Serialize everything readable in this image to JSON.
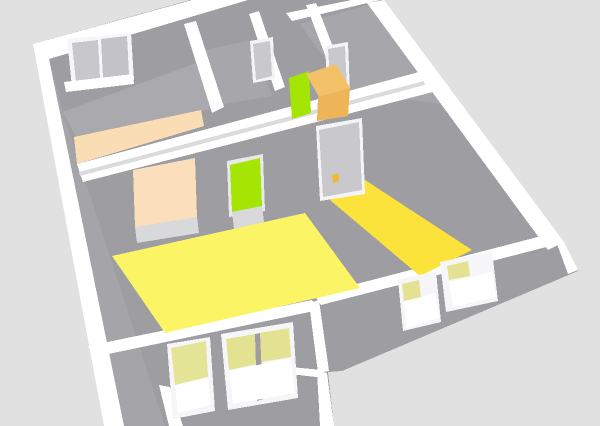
{
  "view": {
    "label": "3d-floor-plan-view",
    "tool": "home-3d-preview",
    "width": 600,
    "height": 426,
    "background": "#E1E1E1"
  },
  "colors": {
    "background": "#E1E1E1",
    "wall_gray": "#9D9DA2",
    "floor_gray": "#A9A9AE",
    "wall_top_white": "#FFFFFF",
    "accent_peach": "#FBDDB5",
    "accent_green": "#A5E503",
    "floor_yellow_light": "#FBF565",
    "floor_yellow_gold": "#FCE33C",
    "furniture_orange": "#F3C168",
    "door_gray": "#C8C8CD",
    "handle_yellow": "#F2B830",
    "window_pane_gray": "#C7C7CC",
    "window_glass_yellow": "#E2E292"
  },
  "scene": {
    "polygons": [
      {
        "name": "house-base-walls",
        "fill": "#9D9DA2",
        "points": "33,44 190,0 383,0 562,241 578,271 342,371 328,372 334,426 108,426 95,352"
      },
      {
        "name": "backleft-room-floor",
        "fill": "#A9A9AE",
        "points": "63,112 250,43 216,108 76,137"
      },
      {
        "name": "small-room-floor",
        "fill": "#A6A6AB",
        "points": "205,50 252,40 272,96 224,104"
      },
      {
        "name": "topright-room-floor",
        "fill": "#A6A6AB",
        "points": "300,24 376,3 458,106 348,92"
      },
      {
        "name": "left-wall-inner-face",
        "fill": "#A4A4A9",
        "points": "49,59 63,112 165,426 124,426"
      },
      {
        "name": "back-wall-top-band",
        "fill": "#FFFFFF",
        "points": "33,44 192,0 248,0 49,59"
      },
      {
        "name": "left-wall-top-band",
        "fill": "#FFFFFF",
        "points": "33,44 49,59 124,426 104,426"
      },
      {
        "name": "middle-wall-top-band",
        "fill": "#FFFFFF",
        "points": "77,164 419,72 433,92 83,182"
      },
      {
        "name": "middle-wall-seam",
        "fill": "#DBDBDE",
        "points": "79,172 424,81 425,85 80,176"
      },
      {
        "name": "closet-wall-band-west",
        "fill": "#FFFFFF",
        "points": "184,24 196,21 224,107 212,113"
      },
      {
        "name": "closet-wall-band-mid",
        "fill": "#FFFFFF",
        "points": "249,14 259,11 285,87 275,91"
      },
      {
        "name": "closet-wall-band-east",
        "fill": "#FFFFFF",
        "points": "306,5 316,3 350,91 340,94"
      },
      {
        "name": "northeast-wall-band",
        "fill": "#FFFFFF",
        "points": "286,13 352,0 380,0 292,21"
      },
      {
        "name": "right-wall-top-band",
        "fill": "#FFFFFF",
        "points": "367,3 384,0 564,242 548,250"
      },
      {
        "name": "front-wall-band-left",
        "fill": "#FFFFFF",
        "points": "88,346 312,300 319,310 94,357"
      },
      {
        "name": "front-wall-band-right",
        "fill": "#FFFFFF",
        "points": "314,295 553,233 562,243 321,305"
      },
      {
        "name": "junction-wall-band",
        "fill": "#FFFFFF",
        "points": "309,303 319,300 329,371 318,373"
      },
      {
        "name": "porch-wall-band-top",
        "fill": "#FFFFFF",
        "points": "280,366 322,370 325,378 281,373"
      },
      {
        "name": "porch-wall-band-right",
        "fill": "#FFFFFF",
        "points": "317,371 327,373 334,426 320,426"
      },
      {
        "name": "porch-wall-band-left",
        "fill": "#FFFFFF",
        "points": "159,385 170,387 183,426 169,426"
      },
      {
        "name": "east-corner-band",
        "fill": "#FFFFFF",
        "points": "553,233 564,242 578,270 568,274"
      },
      {
        "name": "peach-accent-wall",
        "fill": "#FBDDB5",
        "points": "74,137 201,110 204,126 77,164"
      },
      {
        "name": "peach-doorway-opening",
        "fill": "#FBDFBC",
        "points": "133,170 195,158 197,217 135,227"
      },
      {
        "name": "peach-doorway-threshold",
        "fill": "#D9D9DC",
        "points": "135,227 197,217 199,233 137,243"
      },
      {
        "name": "green-door-frame",
        "fill": "#E9E9EB",
        "points": "227,161 263,154 265,211 229,217"
      },
      {
        "name": "green-door",
        "fill": "#A5E503",
        "points": "230,165 260,158 262,206 232,212"
      },
      {
        "name": "green-door-threshold",
        "fill": "#D9D9DC",
        "points": "232,212 262,206 264,222 234,229"
      },
      {
        "name": "livingroom-floor-yellow",
        "fill": "#FBF565",
        "points": "112,256 305,213 360,288 165,333"
      },
      {
        "name": "bedroom-floor-yellow",
        "fill": "#FCE33C",
        "points": "330,200 362,178 472,250 420,276"
      },
      {
        "name": "bedroom-door-frame",
        "fill": "#F4F4F6",
        "points": "316,126 362,118 365,194 320,201"
      },
      {
        "name": "bedroom-door",
        "fill": "#C8C8CD",
        "points": "319,130 359,122 362,190 323,197"
      },
      {
        "name": "bedroom-door-handle",
        "fill": "#F2B830",
        "points": "332,175 338,173 339,181 333,183"
      },
      {
        "name": "closet-door-frame",
        "fill": "#F4F4F6",
        "points": "250,41 273,37 275,79 253,83"
      },
      {
        "name": "closet-door",
        "fill": "#C8C8CD",
        "points": "253,44 270,41 272,76 256,80"
      },
      {
        "name": "northeast-door-frame",
        "fill": "#F4F4F6",
        "points": "325,46 348,42 350,93 328,97"
      },
      {
        "name": "northeast-door",
        "fill": "#C8C8CD",
        "points": "328,49 345,46 347,89 331,93"
      },
      {
        "name": "green-furniture-panel",
        "fill": "#A5E503",
        "points": "289,78 309,71 311,113 292,119"
      },
      {
        "name": "orange-box-top",
        "fill": "#F3C168",
        "points": "306,74 336,64 350,88 319,97"
      },
      {
        "name": "orange-box-front",
        "fill": "#EDB557",
        "points": "318,97 350,88 348,116 317,121"
      },
      {
        "name": "back-window-frame",
        "fill": "#F6F6F8",
        "points": "67,39 131,33 134,80 72,87"
      },
      {
        "name": "back-window-pane-left",
        "fill": "#C7C7CC",
        "points": "72,43 98,40 100,78 76,82"
      },
      {
        "name": "back-window-pane-right",
        "fill": "#C2C2C8",
        "points": "101,39 127,36 129,75 103,78"
      },
      {
        "name": "back-window-sill",
        "fill": "#FFFFFF",
        "points": "64,82 133,74 134,84 66,92"
      },
      {
        "name": "front-door-window-frame",
        "fill": "#F6F6F8",
        "points": "167,344 210,337 215,411 173,419"
      },
      {
        "name": "front-door-window-glass",
        "fill": "#E4E496",
        "points": "171,348 206,341 208,377 175,385"
      },
      {
        "name": "front-door-window-lower",
        "fill": "#FFFFFF",
        "points": "175,385 208,377 211,405 178,413"
      },
      {
        "name": "front-window-frame",
        "fill": "#F6F6F8",
        "points": "221,334 293,322 298,398 228,410"
      },
      {
        "name": "front-window-glass-left",
        "fill": "#E2E292",
        "points": "226,339 255,334 257,364 229,370"
      },
      {
        "name": "front-window-glass-right",
        "fill": "#E2E292",
        "points": "259,333 289,328 291,357 261,362"
      },
      {
        "name": "front-window-mullion",
        "fill": "#9D9DA2",
        "points": "255,334 260,333 263,399 257,401"
      },
      {
        "name": "front-window-open-sash",
        "fill": "#FFFFFF",
        "points": "229,371 291,358 295,393 233,404"
      },
      {
        "name": "right-window1-frame",
        "fill": "#F6F6F8",
        "points": "398,280 436,271 441,322 403,331"
      },
      {
        "name": "right-window1-glass",
        "fill": "#E2E292",
        "points": "402,284 419,280 421,297 404,301"
      },
      {
        "name": "right-window1-open-sash",
        "fill": "#FFFFFF",
        "points": "403,302 435,293 439,318 407,328"
      },
      {
        "name": "right-window2-frame",
        "fill": "#F6F6F8",
        "points": "440,262 492,251 498,301 446,312"
      },
      {
        "name": "right-window2-glass",
        "fill": "#E2E292",
        "points": "447,266 468,261 470,276 449,280"
      },
      {
        "name": "right-window2-open-sash",
        "fill": "#FFFFFF",
        "points": "449,282 492,272 496,297 453,307"
      }
    ]
  }
}
